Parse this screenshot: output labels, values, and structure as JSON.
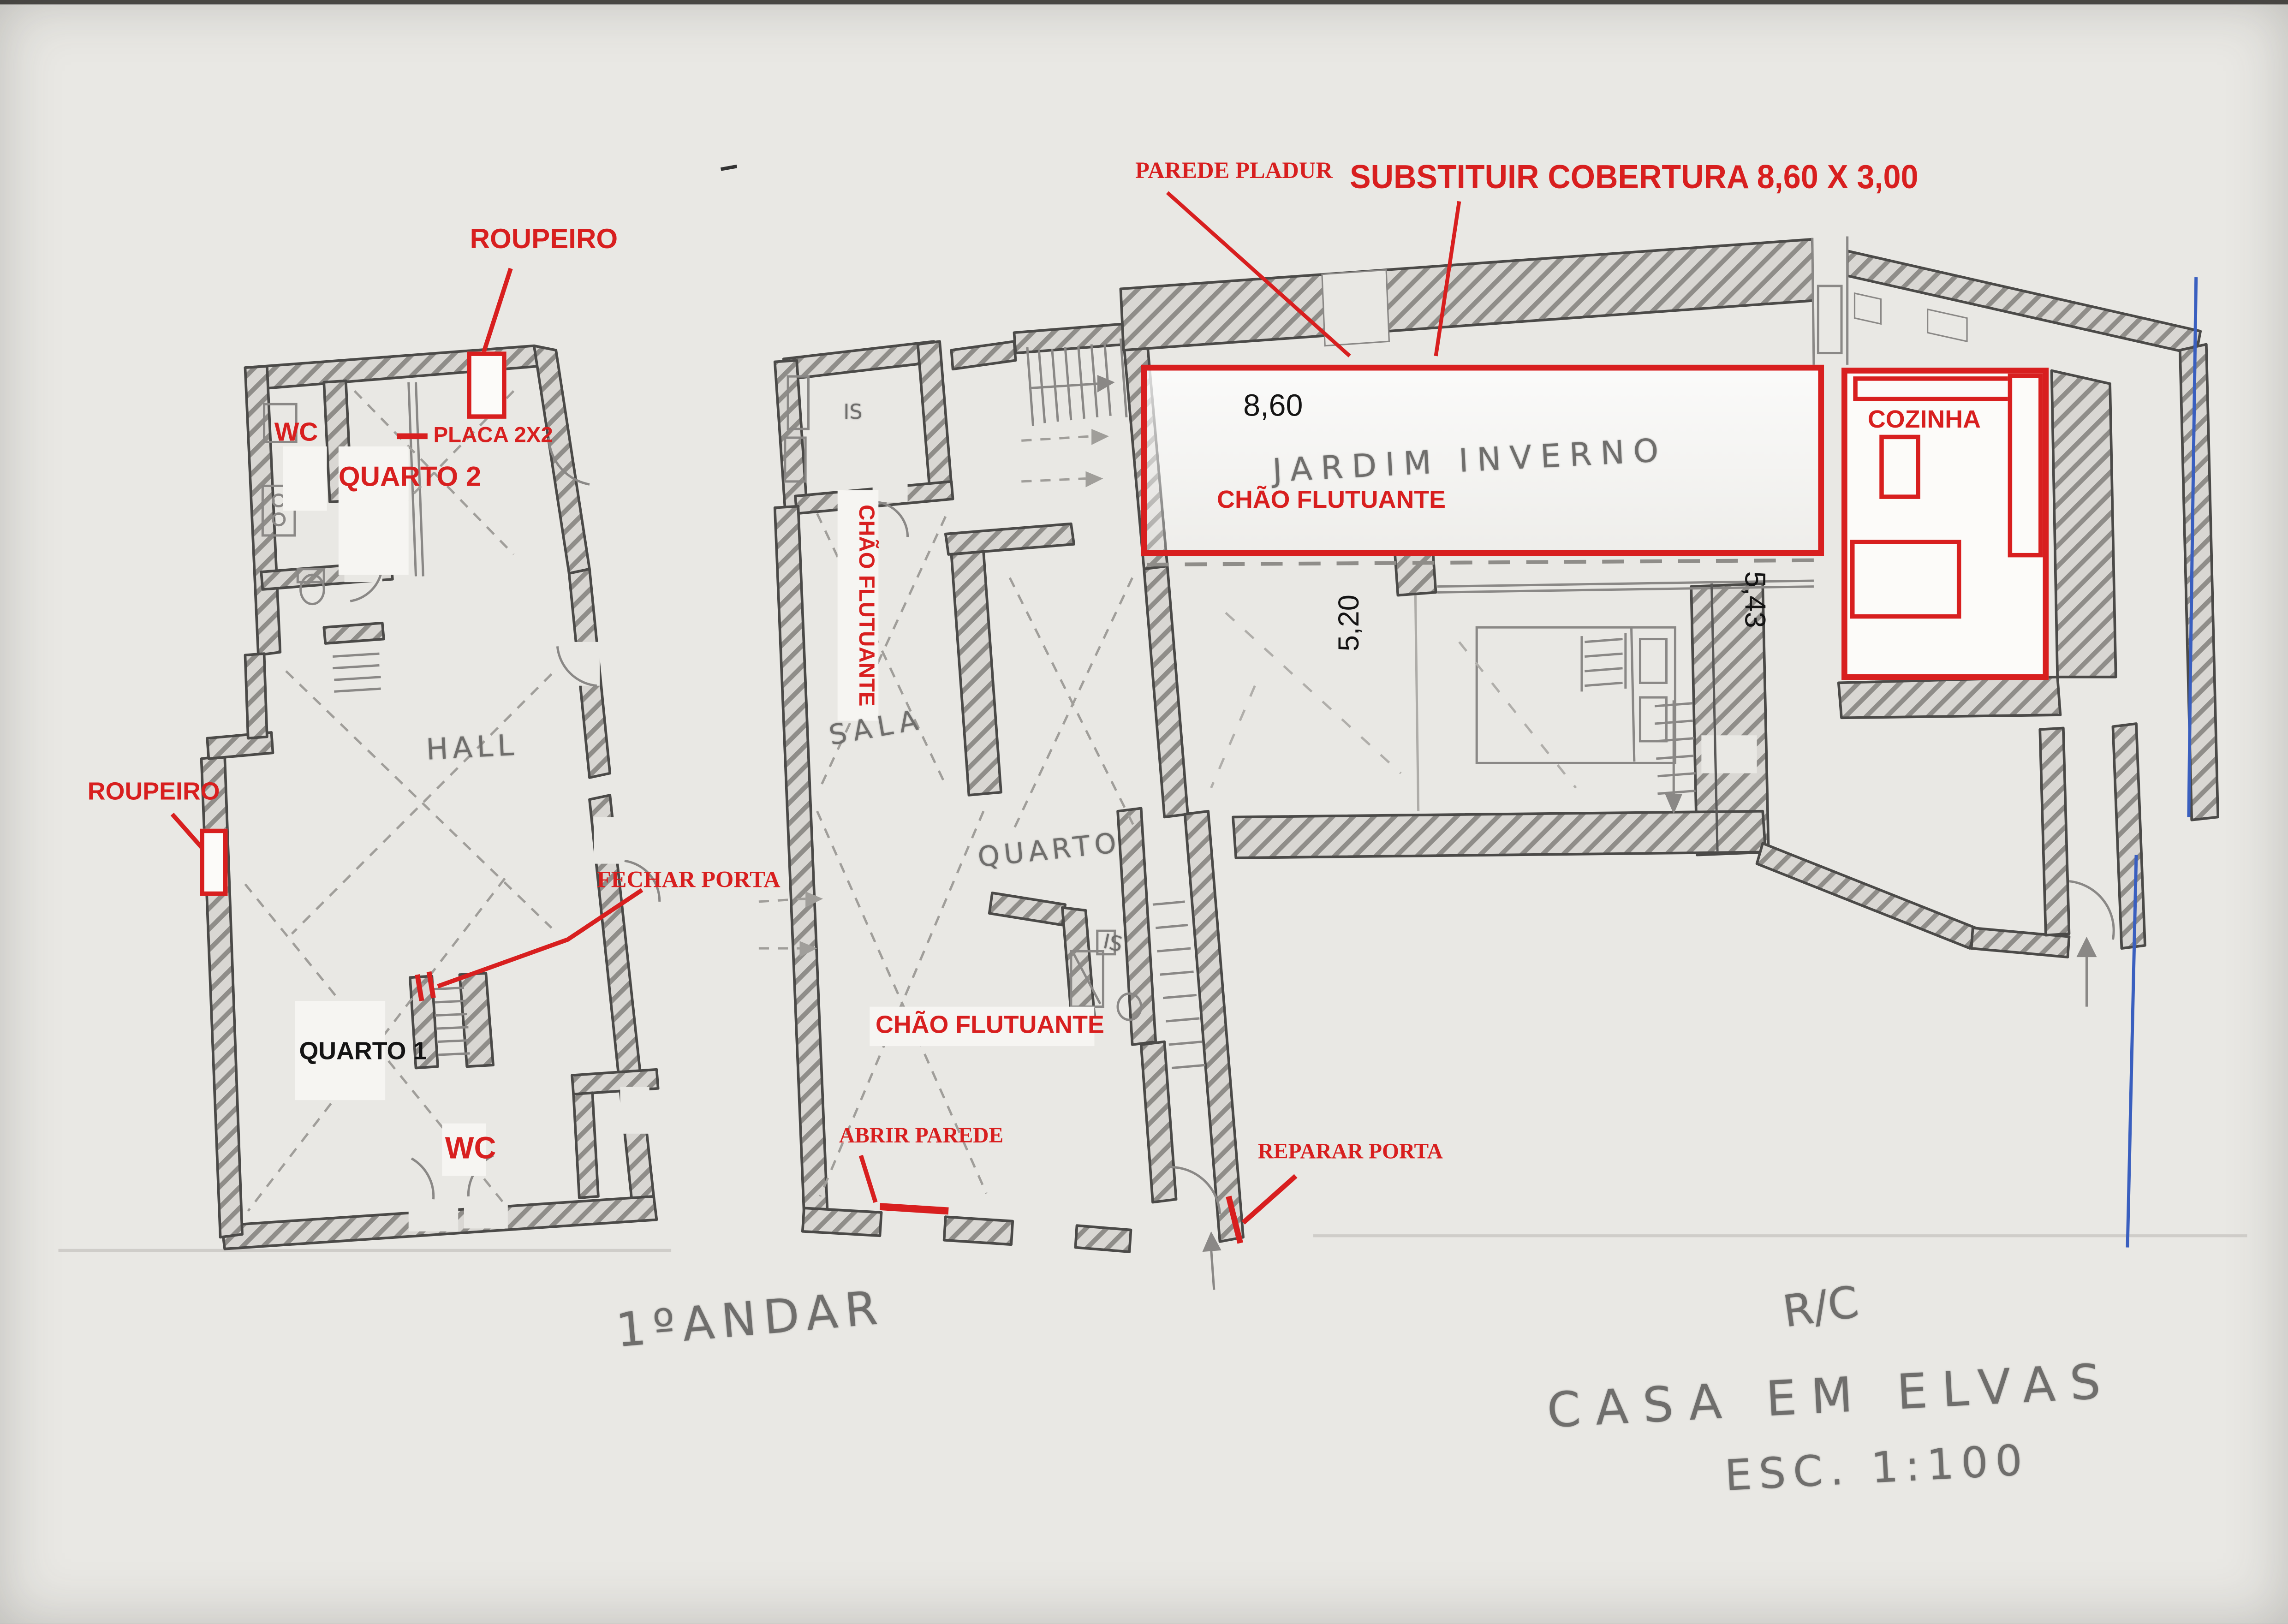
{
  "sheet": {
    "project_title": "CASA EM ELVAS",
    "scale_note": "ESC. 1:100",
    "first_floor_title": "1ºANDAR",
    "ground_floor_title": "R/C"
  },
  "colors": {
    "annotation_red": "#d81f1f",
    "pencil_gray": "#6f6e6c",
    "dimension_black": "#141414",
    "blue_pen": "#3a5fbf",
    "paper": "#e9e8e4"
  },
  "first_floor": {
    "labels": {
      "roupeiro_top": "ROUPEIRO",
      "placa": "PLACA 2X2",
      "wc_upper": "WC",
      "quarto2": "QUARTO 2",
      "hall": "HALL",
      "roupeiro_left": "ROUPEIRO",
      "fechar_porta": "FECHAR PORTA",
      "quarto1": "QUARTO 1",
      "wc_lower": "WC"
    }
  },
  "ground_floor": {
    "labels": {
      "parede_pladur": "PAREDE PLADUR",
      "substituir_cobertura": "SUBSTITUIR COBERTURA 8,60 X 3,00",
      "chao_flutuante_jardim": "CHÃO FLUTUANTE",
      "jardim_inverno": "JARDIM INVERNO",
      "cozinha": "COZINHA",
      "is_top": "IS",
      "chao_flutuante_corridor": "CHÃO FLUTUANTE",
      "sala": "SALA",
      "quarto": "QUARTO",
      "is_mid": "IS",
      "chao_flutuante_sala": "CHÃO FLUTUANTE",
      "abrir_parede": "ABRIR PAREDE",
      "reparar_porta": "REPARAR PORTA"
    },
    "dimensions": {
      "width_top": "8,60",
      "depth_left": "5,20",
      "depth_right": "5,43"
    }
  }
}
